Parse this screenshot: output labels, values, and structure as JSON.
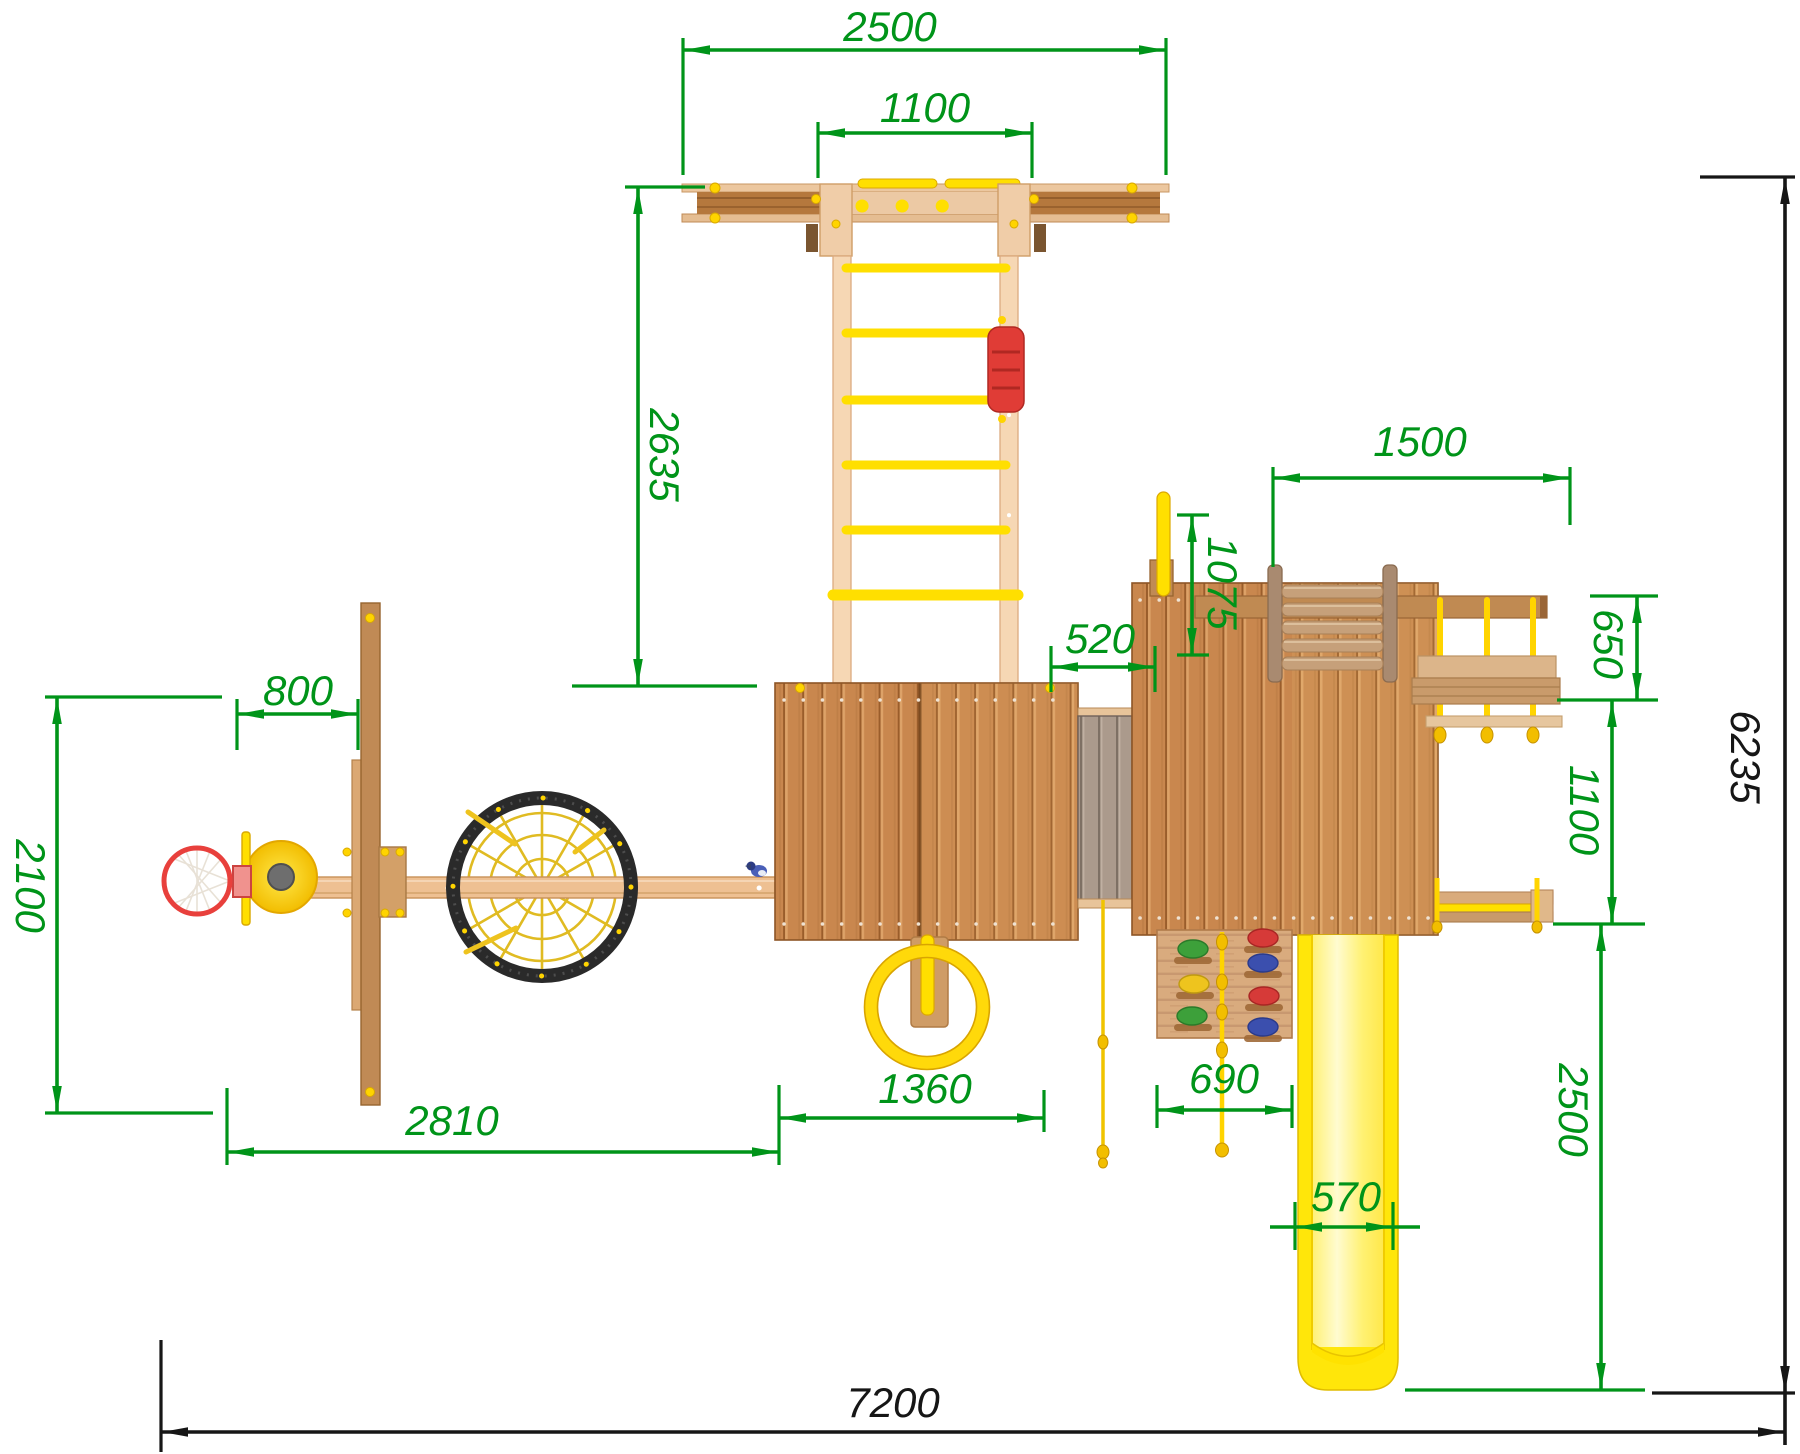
{
  "drawing": {
    "type": "playground-structure-top-view-plan",
    "colors": {
      "dimension_green": "#009419",
      "dimension_black": "#161616",
      "wood_plank": "#c9874e",
      "wood_light": "#f2cfa8",
      "accent_yellow": "#ffdf00",
      "accent_red": "#d63a38",
      "accent_blue": "#3b4fae",
      "accent_green_hold": "#3da03a",
      "net_black": "#2a2a2a"
    },
    "parts": {
      "monkey_bar": "top-beam-with-rungs",
      "ladder": "rope-rung-ladder",
      "climb_grip": "red-climbing-grip",
      "tower_main": "central-tower-roof",
      "tower_right": "right-tower-roof",
      "bridge": "plank-bridge",
      "fireman_pole": "yellow-pole",
      "net_module": "rope-net-frame",
      "swing": "rope-swing-bench",
      "slide": "yellow-slide",
      "climbing_wall": "rock-wall-with-holds",
      "climbing_rope": "knotted-rope",
      "gym_ring": "yellow-ring",
      "nest_swing": "spider-web-nest-swing",
      "basketball": "basketball-hoop-and-board",
      "bird": "small-blue-bird"
    },
    "dims": {
      "top_span": "2500",
      "monkeybar_width": "1100",
      "ladder_length": "2635",
      "pole_height": "1075",
      "swing_frame": "1500",
      "bridge_offset": "520",
      "swing_depth": "650",
      "swing_clear": "1100",
      "total_depth": "6235",
      "slide_run": "2500",
      "hoop_offset": "800",
      "hoop_zone": "2100",
      "left_zone": "2810",
      "ring_zone": "1360",
      "wall_width": "690",
      "slide_width": "570",
      "total_width": "7200"
    }
  }
}
